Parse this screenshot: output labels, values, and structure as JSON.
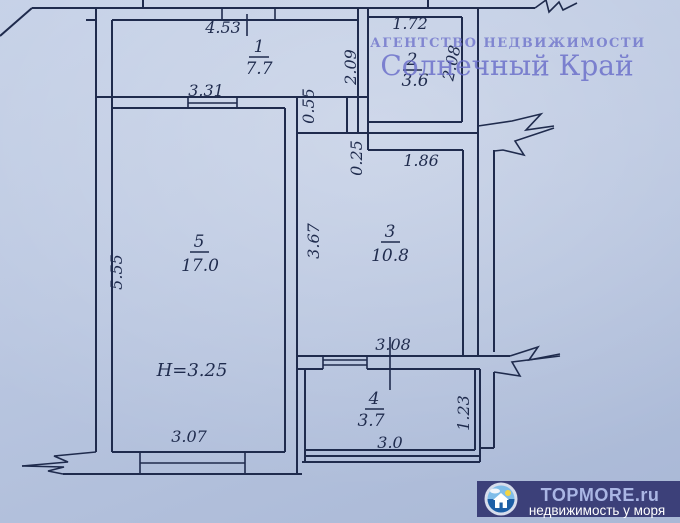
{
  "plan": {
    "rooms": [
      {
        "number": "1",
        "area": "7.7"
      },
      {
        "number": "2",
        "area": "3.6"
      },
      {
        "number": "3",
        "area": "10.8"
      },
      {
        "number": "4",
        "area": "3.7"
      },
      {
        "number": "5",
        "area": "17.0"
      }
    ],
    "dims": {
      "room1_width": "4.53",
      "room5_top_width": "3.31",
      "room2_width": "1.72",
      "room2_height_left": "2.09",
      "room2_height_right": "2.08",
      "hall_step": "0.55",
      "room3_step": "0.25",
      "room3_top_width": "1.86",
      "room3_height": "3.67",
      "room5_height": "5.55",
      "room5_bottom_width": "3.07",
      "room3_bottom_width": "3.08",
      "room4_width": "3.0",
      "room4_height": "1.23"
    },
    "height_note": "H=3.25"
  },
  "watermarks": {
    "agency_line1": "АГЕНТСТВО НЕДВИЖИМОСТИ",
    "agency_line2": "Солнечный Край"
  },
  "banner": {
    "title": "TOPMORE.ru",
    "subtitle": "недвижимость у моря"
  },
  "colors": {
    "background": "#b9c6e0",
    "line": "#1f2b4d",
    "watermark": "#6569c8",
    "banner_background": "#3c4079",
    "banner_title": "#aab6e4",
    "banner_subtitle": "#ffffff"
  }
}
